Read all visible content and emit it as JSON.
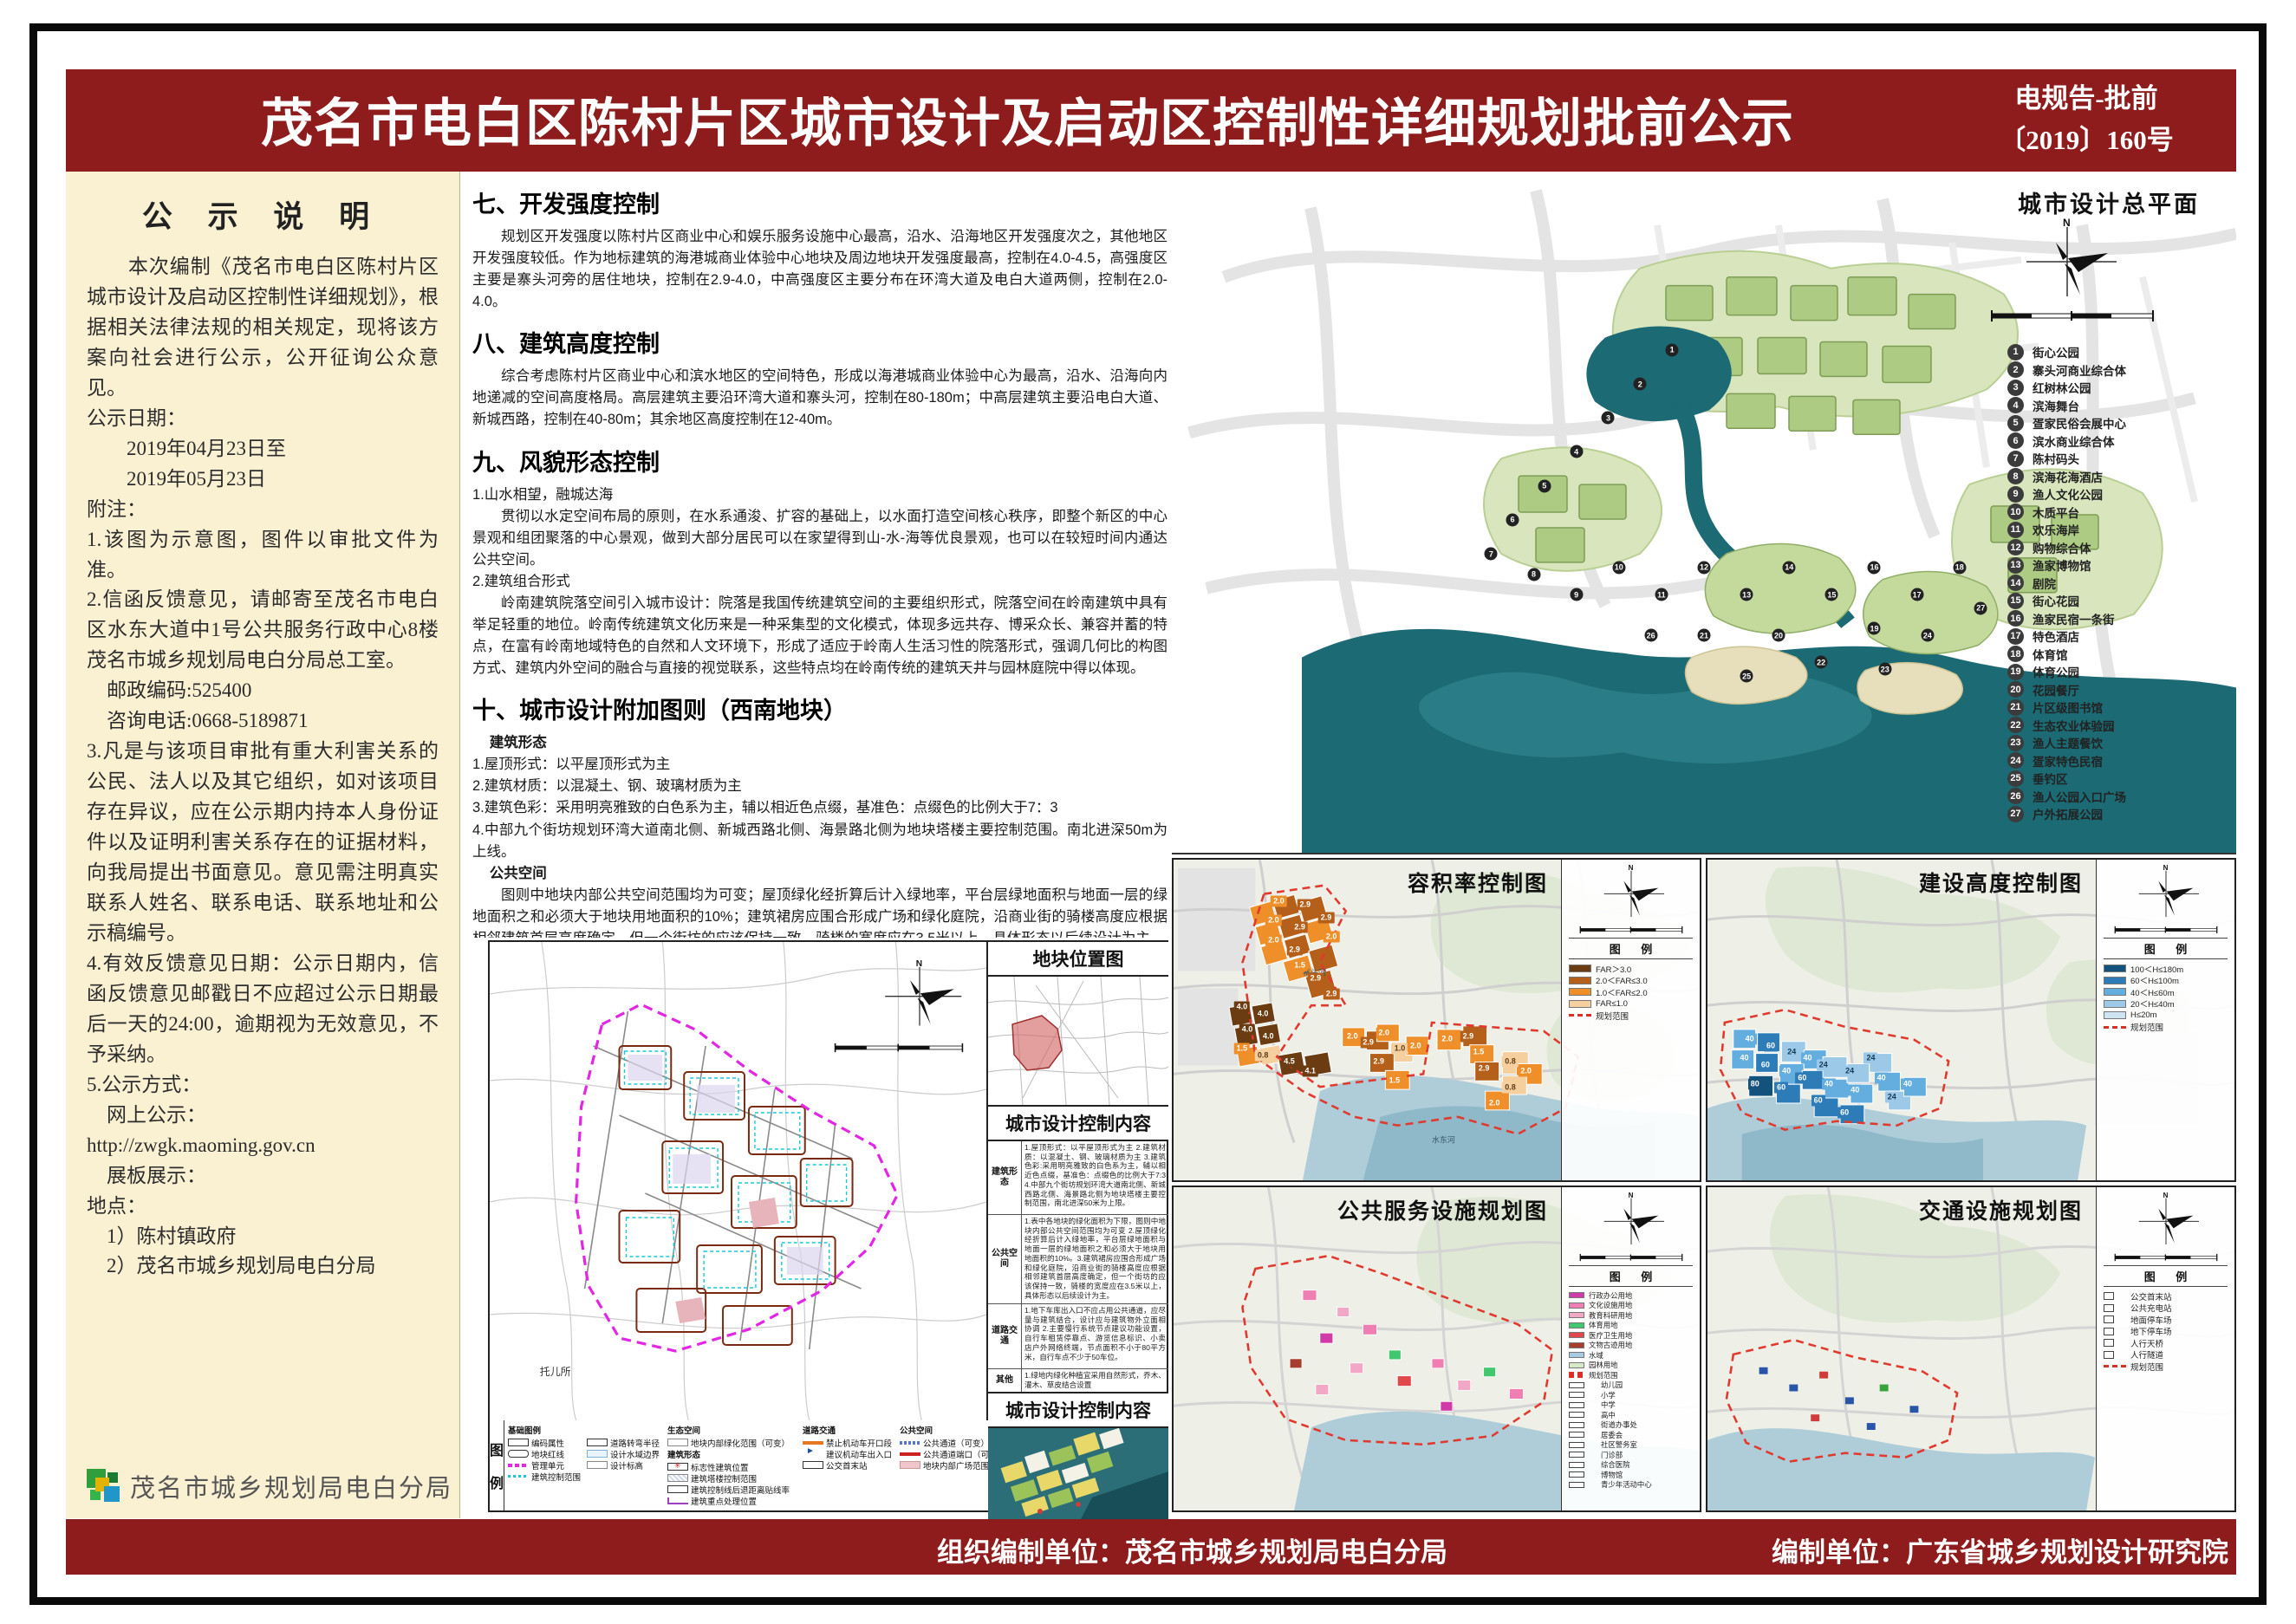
{
  "header": {
    "title": "茂名市电白区陈村片区城市设计及启动区控制性详细规划批前公示",
    "doc_no_line1": "电规告-批前",
    "doc_no_line2": "〔2019〕160号"
  },
  "footer": {
    "org_unit": "组织编制单位：茂名市城乡规划局电白分局",
    "design_unit": "编制单位：广东省城乡规划设计研究院"
  },
  "sidebar": {
    "title": "公  示  说  明",
    "paragraphs": [
      "　　本次编制《茂名市电白区陈村片区城市设计及启动区控制性详细规划》，根据相关法律法规的相关规定，现将该方案向社会进行公示，公开征询公众意见。",
      "公示日期：",
      "　　2019年04月23日至",
      "　　2019年05月23日",
      "附注：",
      "1.该图为示意图，图件以审批文件为准。",
      "2.信函反馈意见，请邮寄至茂名市电白区水东大道中1号公共服务行政中心8楼茂名市城乡规划局电白分局总工室。",
      "　邮政编码:525400",
      "　咨询电话:0668-5189871",
      "3.凡是与该项目审批有重大利害关系的公民、法人以及其它组织，如对该项目存在异议，应在公示期内持本人身份证件以及证明利害关系存在的证据材料，向我局提出书面意见。意见需注明真实联系人姓名、联系电话、联系地址和公示稿编号。",
      "4.有效反馈意见日期：公示日期内，信函反馈意见邮戳日不应超过公示日期最后一天的24:00，逾期视为无效意见，不予采纳。",
      "5.公示方式：",
      "　网上公示：",
      "http://zwgk.maoming.gov.cn",
      "　展板展示：",
      "地点：",
      "　1）陈村镇政府",
      "　2）茂名市城乡规划局电白分局"
    ],
    "logo_text": "茂名市城乡规划局电白分局"
  },
  "sections": {
    "s7": {
      "head": "七、开发强度控制",
      "p1": "规划区开发强度以陈村片区商业中心和娱乐服务设施中心最高，沿水、沿海地区开发强度次之，其他地区开发强度较低。作为地标建筑的海港城商业体验中心地块及周边地块开发强度最高，控制在4.0-4.5，高强度区主要是寨头河旁的居住地块，控制在2.9-4.0，中高强度区主要分布在环湾大道及电白大道两侧，控制在2.0-4.0。"
    },
    "s8": {
      "head": "八、建筑高度控制",
      "p1": "综合考虑陈村片区商业中心和滨水地区的空间特色，形成以海港城商业体验中心为最高，沿水、沿海向内地递减的空间高度格局。高层建筑主要沿环湾大道和寨头河，控制在80-180m；中高层建筑主要沿电白大道、新城西路，控制在40-80m；其余地区高度控制在12-40m。"
    },
    "s9": {
      "head": "九、风貌形态控制",
      "sub1": "1.山水相望，融城达海",
      "p1": "贯彻以水定空间布局的原则，在水系通浚、扩容的基础上，以水面打造空间核心秩序，即整个新区的中心景观和组团聚落的中心景观，做到大部分居民可以在家望得到山-水-海等优良景观，也可以在较短时间内通达公共空间。",
      "sub2": "2.建筑组合形式",
      "p2": "岭南建筑院落空间引入城市设计：院落是我国传统建筑空间的主要组织形式，院落空间在岭南建筑中具有举足轻重的地位。岭南传统建筑文化历来是一种采集型的文化模式，体现多远共存、博采众长、兼容并蓄的特点，在富有岭南地域特色的自然和人文环境下，形成了适应于岭南人生活习性的院落形式，强调几何比的构图方式、建筑内外空间的融合与直接的视觉联系，这些特点均在岭南传统的建筑天井与园林庭院中得以体现。"
    },
    "s10": {
      "head": "十、城市设计附加图则（西南地块）",
      "sub1": "建筑形态",
      "i1": "1.屋顶形式：以平屋顶形式为主",
      "i2": "2.建筑材质：以混凝土、钢、玻璃材质为主",
      "i3": "3.建筑色彩：采用明亮雅致的白色系为主，辅以相近色点缀，基准色：点缀色的比例大于7：3",
      "i4": "4.中部九个街坊规划环湾大道南北侧、新城西路北侧、海景路北侧为地块塔楼主要控制范围。南北进深50m为上线。",
      "sub2": "公共空间",
      "p2": "图则中地块内部公共空间范围均为可变；屋顶绿化经折算后计入绿地率，平台层绿地面积与地面一层的绿地面积之和必须大于地块用地面积的10%；建筑裙房应围合形成广场和绿化庭院，沿商业街的骑楼高度应根据相邻建筑首层高度确定，但一个街坊的应该保持一致，骑楼的宽度应在3.5米以上，具体形态以后续设计为主。",
      "sub3": "道路交通",
      "p3a": "地下车库出入口不应占用公共通道，应尽量与建筑结合，设计应与建筑物外立面相协调。",
      "p3b": "主要慢行系统节点建议功能设置，自行车租赁停靠点、游览信息标识、小卖店户外网络终端，节点面积不小于80平方米，自行车点不少于50车位。"
    }
  },
  "master": {
    "title": "城市设计总平面",
    "legend": [
      {
        "label": "街心公园"
      },
      {
        "label": "寨头河商业综合体"
      },
      {
        "label": "红树林公园"
      },
      {
        "label": "滨海舞台"
      },
      {
        "label": "疍家民俗会展中心"
      },
      {
        "label": "滨水商业综合体"
      },
      {
        "label": "陈村码头"
      },
      {
        "label": "滨海花海酒店"
      },
      {
        "label": "渔人文化公园"
      },
      {
        "label": "木质平台"
      },
      {
        "label": "欢乐海岸"
      },
      {
        "label": "购物综合体"
      },
      {
        "label": "渔家博物馆"
      },
      {
        "label": "剧院"
      },
      {
        "label": "街心花园"
      },
      {
        "label": "渔家民宿一条街"
      },
      {
        "label": "特色酒店"
      },
      {
        "label": "体育馆"
      },
      {
        "label": "体育公园"
      },
      {
        "label": "花园餐厅"
      },
      {
        "label": "片区级图书馆"
      },
      {
        "label": "生态农业体验园"
      },
      {
        "label": "渔人主题餐饮"
      },
      {
        "label": "疍家特色民宿"
      },
      {
        "label": "垂钓区"
      },
      {
        "label": "渔人公园入口广场"
      },
      {
        "label": "户外拓展公园"
      }
    ],
    "markers": [
      {
        "x": 47,
        "y": 26
      },
      {
        "x": 44,
        "y": 31
      },
      {
        "x": 41,
        "y": 36
      },
      {
        "x": 38,
        "y": 41
      },
      {
        "x": 35,
        "y": 46
      },
      {
        "x": 32,
        "y": 51
      },
      {
        "x": 30,
        "y": 56
      },
      {
        "x": 34,
        "y": 59
      },
      {
        "x": 38,
        "y": 62
      },
      {
        "x": 42,
        "y": 58
      },
      {
        "x": 46,
        "y": 62
      },
      {
        "x": 50,
        "y": 58
      },
      {
        "x": 54,
        "y": 62
      },
      {
        "x": 58,
        "y": 58
      },
      {
        "x": 62,
        "y": 62
      },
      {
        "x": 66,
        "y": 58
      },
      {
        "x": 70,
        "y": 62
      },
      {
        "x": 74,
        "y": 58
      },
      {
        "x": 66,
        "y": 67
      },
      {
        "x": 57,
        "y": 68
      },
      {
        "x": 50,
        "y": 68
      },
      {
        "x": 61,
        "y": 72
      },
      {
        "x": 67,
        "y": 73
      },
      {
        "x": 71,
        "y": 68
      },
      {
        "x": 54,
        "y": 74
      },
      {
        "x": 45,
        "y": 68
      },
      {
        "x": 76,
        "y": 64
      }
    ]
  },
  "central": {
    "location_title": "地块位置图",
    "control_title": "城市设计控制内容",
    "map_label": "托儿所",
    "legend_side": "图 例",
    "rows": [
      {
        "label": "建筑形态",
        "text": "1.屋顶形式：以平屋顶形式为主 2.建筑材质：以混凝土、钢、玻璃材质为主 3.建筑色彩:采用明亮雅致的白色系为主，辅以相近色点缀，基准色：点缀色的比例大于7:3 4.中部九个街坊规划环湾大道南北侧、新城西路北侧、海景路北侧为地块塔楼主要控制范围，南北进深50米为上限。"
      },
      {
        "label": "公共空间",
        "text": "1.表中各地块的绿化面积为下限，图则中地块内部公共空间范围均为可变 2.屋顶绿化经折算后计入绿地率，平台层绿地面积与地面一层的绿地面积之和必须大于地块用地面积的10%。3.建筑裙房应围合形成广场和绿化庭院，沿商业街的骑楼高度应根据相邻建筑首层高度确定，但一个街坊的应该保持一致，骑楼的宽度应在3.5米以上，具体形态以后续设计为主。"
      },
      {
        "label": "道路交通",
        "text": "1.地下车库出入口不应占用公共通道，应尽量与建筑结合，设计应与建筑物外立面相协调 2.主要慢行系统节点建议功能设置，自行车租赁停靠点、游览信息标识、小卖店户外网络终端，节点面积不小于80平方米，自行车点不少于50车位。"
      },
      {
        "label": "其他",
        "text": "1.绿地内绿化种植宜采用自然形式，乔木、灌木、草皮结合设置"
      }
    ],
    "legend": {
      "basic_title": "基础图例",
      "basic": [
        {
          "label": "编码属性",
          "sym": "sym-code"
        },
        {
          "label": "地块红线",
          "sym": "sym-redline"
        },
        {
          "label": "管理单元",
          "sym": "sym-mgmt"
        },
        {
          "label": "建筑控制范围",
          "sym": "sym-ctrl"
        },
        {
          "label": "道路转弯半径",
          "sym": "sym-radius"
        },
        {
          "label": "设计水域边界",
          "sym": "sym-water"
        },
        {
          "label": "设计标高",
          "sym": "sym-elev"
        }
      ],
      "eco_title": "生态空间",
      "eco": [
        {
          "label": "地块内部绿化范围（可变）",
          "sym": "sym-green"
        }
      ],
      "form_title": "建筑形态",
      "form": [
        {
          "label": "标志性建筑位置",
          "sym": "sym-landmark"
        },
        {
          "label": "建筑塔楼控制范围",
          "sym": "sym-tower"
        },
        {
          "label": "建筑控制线后退距离贴线率",
          "sym": "sym-setback"
        },
        {
          "label": "建筑重点处理位置",
          "sym": "sym-key"
        }
      ],
      "road_title": "道路交通",
      "road": [
        {
          "label": "禁止机动车开口段",
          "sym": "sym-noopen"
        },
        {
          "label": "建议机动车出入口",
          "sym": "sym-entry"
        },
        {
          "label": "公交首末站",
          "sym": "sym-bus"
        }
      ],
      "pub_title": "公共空间",
      "pub": [
        {
          "label": "公共通道（可变）",
          "sym": "sym-passage"
        },
        {
          "label": "公共通道端口（可变）",
          "sym": "sym-port"
        },
        {
          "label": "地块内部广场范围(可变)",
          "sym": "sym-plaza"
        }
      ]
    }
  },
  "panels": {
    "legend_header": "图  例",
    "far": {
      "title": "容积率控制图",
      "river1": "寨头河",
      "river2": "水东河",
      "legend": [
        {
          "label": "FAR＞3.0",
          "c": "#6b3b12"
        },
        {
          "label": "2.0＜FAR≤3.0",
          "c": "#b4601a"
        },
        {
          "label": "1.0＜FAR≤2.0",
          "c": "#ef8f2a"
        },
        {
          "label": "FAR≤1.0",
          "c": "#f6cf9f"
        },
        {
          "label": "规划范围",
          "cls": "dash-red"
        }
      ],
      "chips": [
        {
          "v": "2.0",
          "x": 20,
          "y": 13,
          "c": "#ef8f2a"
        },
        {
          "v": "2.9",
          "x": 25,
          "y": 14,
          "c": "#b4601a"
        },
        {
          "v": "2.0",
          "x": 19,
          "y": 19,
          "c": "#ef8f2a"
        },
        {
          "v": "2.9",
          "x": 24,
          "y": 21,
          "c": "#b4601a"
        },
        {
          "v": "2.0",
          "x": 19,
          "y": 25,
          "c": "#ef8f2a"
        },
        {
          "v": "2.9",
          "x": 23,
          "y": 28,
          "c": "#b4601a"
        },
        {
          "v": "2.9",
          "x": 29,
          "y": 18,
          "c": "#b4601a"
        },
        {
          "v": "2.0",
          "x": 30,
          "y": 24,
          "c": "#ef8f2a"
        },
        {
          "v": "1.5",
          "x": 24,
          "y": 33,
          "c": "#ef8f2a"
        },
        {
          "v": "2.9",
          "x": 27,
          "y": 37,
          "c": "#b4601a"
        },
        {
          "v": "2.9",
          "x": 30,
          "y": 42,
          "c": "#b4601a"
        },
        {
          "v": "4.0",
          "x": 13,
          "y": 46,
          "c": "#6b3b12"
        },
        {
          "v": "4.0",
          "x": 17,
          "y": 48,
          "c": "#6b3b12"
        },
        {
          "v": "4.0",
          "x": 14,
          "y": 53,
          "c": "#6b3b12"
        },
        {
          "v": "4.0",
          "x": 18,
          "y": 55,
          "c": "#6b3b12"
        },
        {
          "v": "1.5",
          "x": 13,
          "y": 59,
          "c": "#ef8f2a"
        },
        {
          "v": "0.8",
          "x": 17,
          "y": 61,
          "c": "#f6cf9f",
          "tc": "#5d3d16"
        },
        {
          "v": "4.5",
          "x": 22,
          "y": 63,
          "c": "#6b3b12"
        },
        {
          "v": "4.1",
          "x": 26,
          "y": 66,
          "c": "#6b3b12"
        },
        {
          "v": "2.0",
          "x": 34,
          "y": 55,
          "c": "#ef8f2a"
        },
        {
          "v": "2.9",
          "x": 37,
          "y": 57,
          "c": "#b4601a"
        },
        {
          "v": "2.0",
          "x": 40,
          "y": 54,
          "c": "#ef8f2a"
        },
        {
          "v": "1.0",
          "x": 43,
          "y": 59,
          "c": "#f6cf9f",
          "tc": "#5d3d16"
        },
        {
          "v": "2.9",
          "x": 39,
          "y": 63,
          "c": "#b4601a"
        },
        {
          "v": "1.5",
          "x": 42,
          "y": 69,
          "c": "#ef8f2a"
        },
        {
          "v": "2.0",
          "x": 46,
          "y": 58,
          "c": "#ef8f2a"
        },
        {
          "v": "2.0",
          "x": 52,
          "y": 56,
          "c": "#ef8f2a"
        },
        {
          "v": "2.9",
          "x": 56,
          "y": 55,
          "c": "#b4601a"
        },
        {
          "v": "1.5",
          "x": 58,
          "y": 60,
          "c": "#ef8f2a"
        },
        {
          "v": "2.9",
          "x": 59,
          "y": 65,
          "c": "#b4601a"
        },
        {
          "v": "0.8",
          "x": 64,
          "y": 63,
          "c": "#f6cf9f",
          "tc": "#5d3d16"
        },
        {
          "v": "2.0",
          "x": 67,
          "y": 66,
          "c": "#ef8f2a"
        },
        {
          "v": "0.8",
          "x": 64,
          "y": 71,
          "c": "#f6cf9f",
          "tc": "#5d3d16"
        },
        {
          "v": "2.0",
          "x": 61,
          "y": 76,
          "c": "#ef8f2a"
        }
      ]
    },
    "height": {
      "title": "建设高度控制图",
      "legend": [
        {
          "label": "100＜H≤180m",
          "c": "#14527e"
        },
        {
          "label": "60＜H≤100m",
          "c": "#2d7cb8"
        },
        {
          "label": "40＜H≤60m",
          "c": "#63aede"
        },
        {
          "label": "20＜H≤40m",
          "c": "#9cc9e8"
        },
        {
          "label": "H≤20m",
          "c": "#cfe4f2"
        },
        {
          "label": "规划范围",
          "cls": "dash-red"
        }
      ],
      "chips": [
        {
          "v": "40",
          "x": 8,
          "y": 56,
          "c": "#63aede"
        },
        {
          "v": "60",
          "x": 12,
          "y": 58,
          "c": "#2d7cb8"
        },
        {
          "v": "40",
          "x": 7,
          "y": 62,
          "c": "#63aede"
        },
        {
          "v": "60",
          "x": 11,
          "y": 64,
          "c": "#2d7cb8"
        },
        {
          "v": "24",
          "x": 16,
          "y": 60,
          "c": "#9cc9e8",
          "tc": "#123a57"
        },
        {
          "v": "40",
          "x": 15,
          "y": 66,
          "c": "#63aede"
        },
        {
          "v": "60",
          "x": 14,
          "y": 71,
          "c": "#2d7cb8"
        },
        {
          "v": "80",
          "x": 9,
          "y": 70,
          "c": "#14527e"
        },
        {
          "v": "40",
          "x": 19,
          "y": 62,
          "c": "#63aede"
        },
        {
          "v": "60",
          "x": 18,
          "y": 68,
          "c": "#2d7cb8"
        },
        {
          "v": "24",
          "x": 22,
          "y": 64,
          "c": "#9cc9e8",
          "tc": "#123a57"
        },
        {
          "v": "40",
          "x": 23,
          "y": 70,
          "c": "#63aede"
        },
        {
          "v": "60",
          "x": 21,
          "y": 75,
          "c": "#2d7cb8"
        },
        {
          "v": "24",
          "x": 27,
          "y": 66,
          "c": "#9cc9e8",
          "tc": "#123a57"
        },
        {
          "v": "40",
          "x": 28,
          "y": 72,
          "c": "#63aede"
        },
        {
          "v": "24",
          "x": 31,
          "y": 62,
          "c": "#9cc9e8",
          "tc": "#123a57"
        },
        {
          "v": "40",
          "x": 33,
          "y": 68,
          "c": "#63aede"
        },
        {
          "v": "24",
          "x": 35,
          "y": 74,
          "c": "#9cc9e8",
          "tc": "#123a57"
        },
        {
          "v": "40",
          "x": 38,
          "y": 70,
          "c": "#63aede"
        },
        {
          "v": "60",
          "x": 26,
          "y": 79,
          "c": "#2d7cb8"
        }
      ]
    },
    "service": {
      "title": "公共服务设施规划图",
      "legend": [
        {
          "label": "行政办公用地",
          "c": "#d13ba8"
        },
        {
          "label": "文化设施用地",
          "c": "#ef7fb3"
        },
        {
          "label": "教育科研用地",
          "c": "#f2a7c6"
        },
        {
          "label": "体育用地",
          "c": "#41c76d"
        },
        {
          "label": "医疗卫生用地",
          "c": "#e0484b"
        },
        {
          "label": "文物古迹用地",
          "c": "#a63d2f"
        },
        {
          "label": "水域",
          "c": "#a9cbe2"
        },
        {
          "label": "园林用地",
          "c": "#d8e9c8"
        },
        {
          "label": "规划范围",
          "cls": "dash-red"
        },
        {
          "label": "幼儿园",
          "cls": "pt"
        },
        {
          "label": "小学",
          "cls": "pt"
        },
        {
          "label": "中学",
          "cls": "pt"
        },
        {
          "label": "高中",
          "cls": "pt"
        },
        {
          "label": "街道办事处",
          "cls": "pt"
        },
        {
          "label": "居委会",
          "cls": "pt"
        },
        {
          "label": "社区警务室",
          "cls": "pt"
        },
        {
          "label": "门诊部",
          "cls": "pt"
        },
        {
          "label": "综合医院",
          "cls": "pt"
        },
        {
          "label": "博物馆",
          "cls": "pt"
        },
        {
          "label": "青少年活动中心",
          "cls": "pt"
        }
      ]
    },
    "traffic": {
      "title": "交通设施规划图",
      "legend": [
        {
          "label": "公交首末站",
          "cls": "pt"
        },
        {
          "label": "公共充电站",
          "cls": "pt"
        },
        {
          "label": "地面停车场",
          "cls": "pt"
        },
        {
          "label": "地下停车场",
          "cls": "pt"
        },
        {
          "label": "人行天桥",
          "cls": "pt"
        },
        {
          "label": "人行隧道",
          "cls": "pt"
        },
        {
          "label": "规划范围",
          "cls": "dash-red"
        }
      ]
    }
  }
}
